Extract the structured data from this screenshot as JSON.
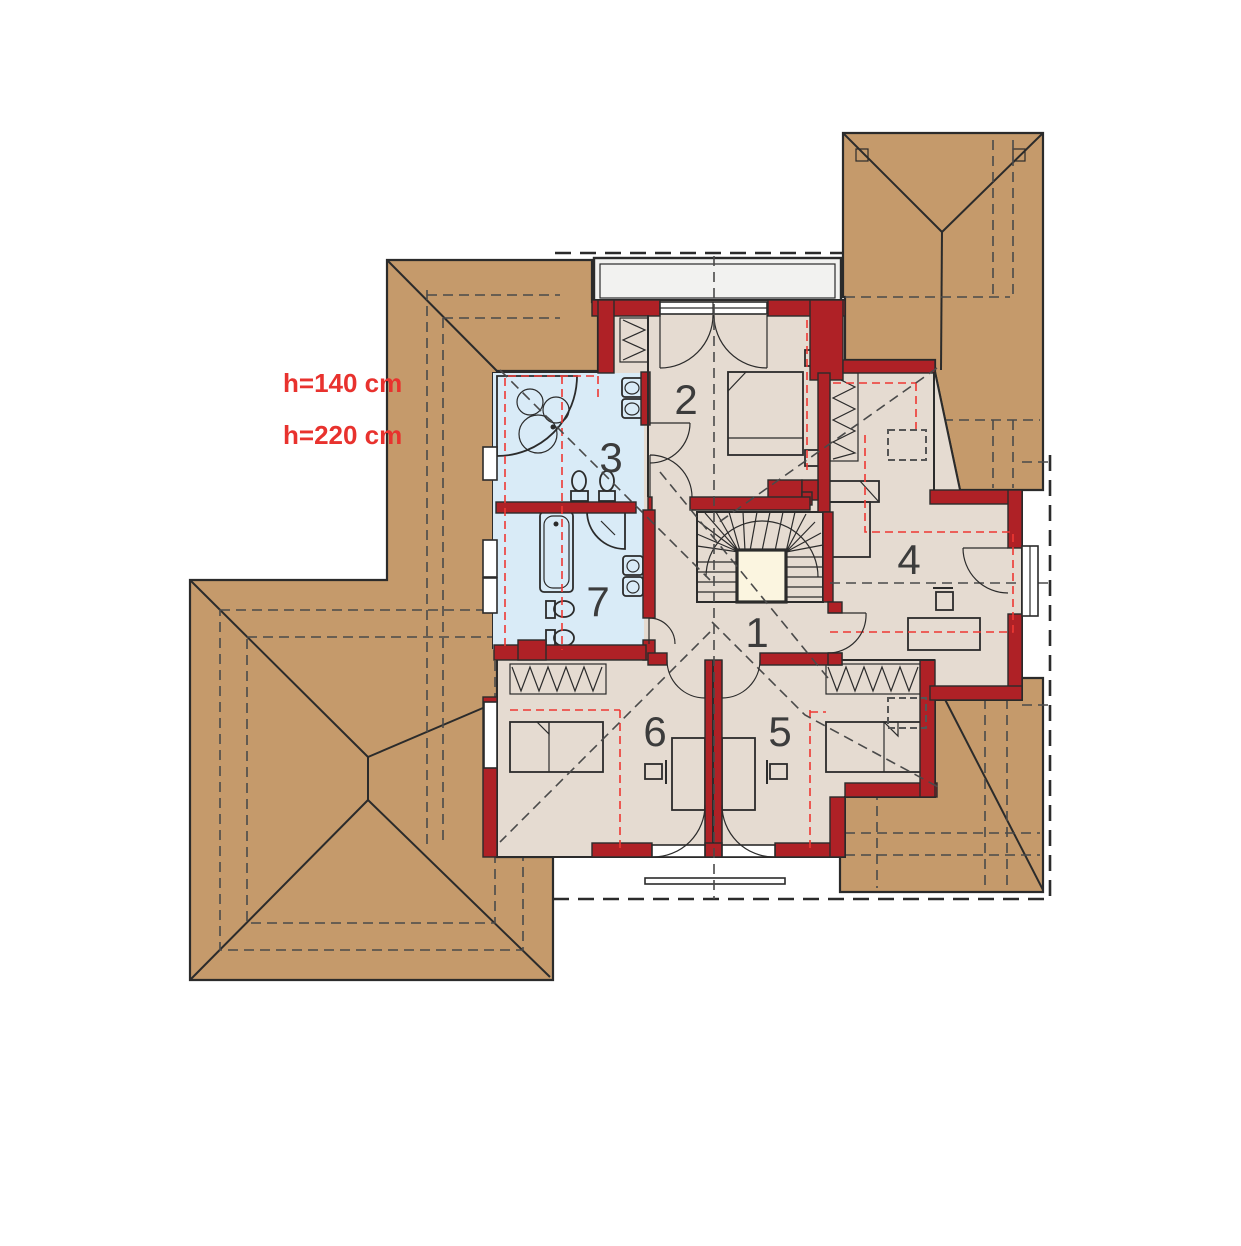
{
  "document": {
    "type": "attic floor plan drawing"
  },
  "annotations": [
    "h=140 cm",
    "h=220 cm"
  ],
  "rooms": [
    {
      "number": "1"
    },
    {
      "number": "2"
    },
    {
      "number": "3"
    },
    {
      "number": "4"
    },
    {
      "number": "5"
    },
    {
      "number": "6"
    },
    {
      "number": "7"
    }
  ],
  "colors": {
    "roof": "#C59A6B",
    "wall": "#AF2126",
    "room": "#E5DBD1",
    "bath": "#D9EBF7",
    "stairwell": "#FBF5E0",
    "balcony": "#F2F2F0",
    "outline": "#2B2B2B",
    "reddash": "#EE3833",
    "graydash": "#4A4A4A",
    "number": "#3C3C3C",
    "labelred": "#E8322E",
    "background": "#FFFFFF"
  }
}
